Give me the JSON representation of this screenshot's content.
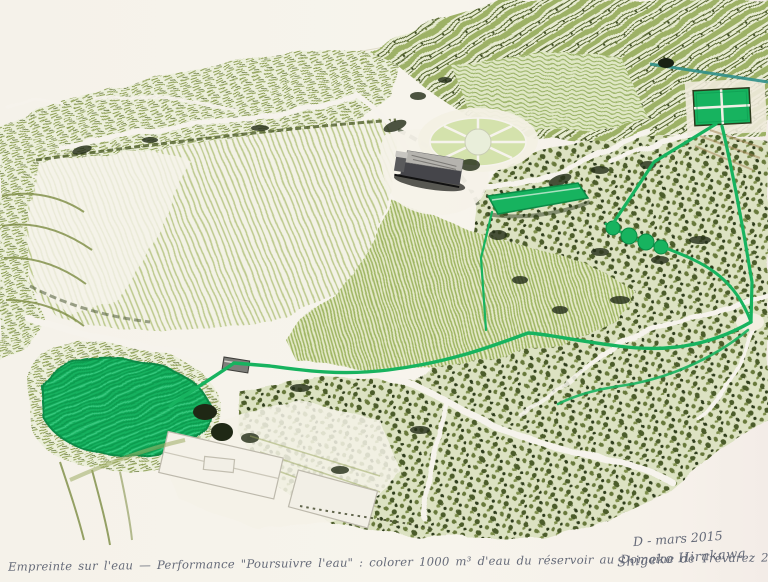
{
  "artwork": {
    "caption_line": "Empreinte sur l'eau — Performance \"Poursuivre l'eau\" : colorer 1000 m³ d'eau du réservoir au Domaine de Trévarez 2014",
    "date_note": "D - mars 2015",
    "signature": "Shigeko Hirakawa"
  },
  "palette": {
    "paper": "#f6f3ec",
    "marker_green": "#17b35f",
    "marker_green_dark": "#0c8a46",
    "olive": "#8a9c50",
    "olive_dark": "#5a6c2f",
    "forest_ink": "#26301a",
    "teal_line": "#2f8f88",
    "building_gray": "#45454a",
    "pencil_text": "#666b79"
  }
}
